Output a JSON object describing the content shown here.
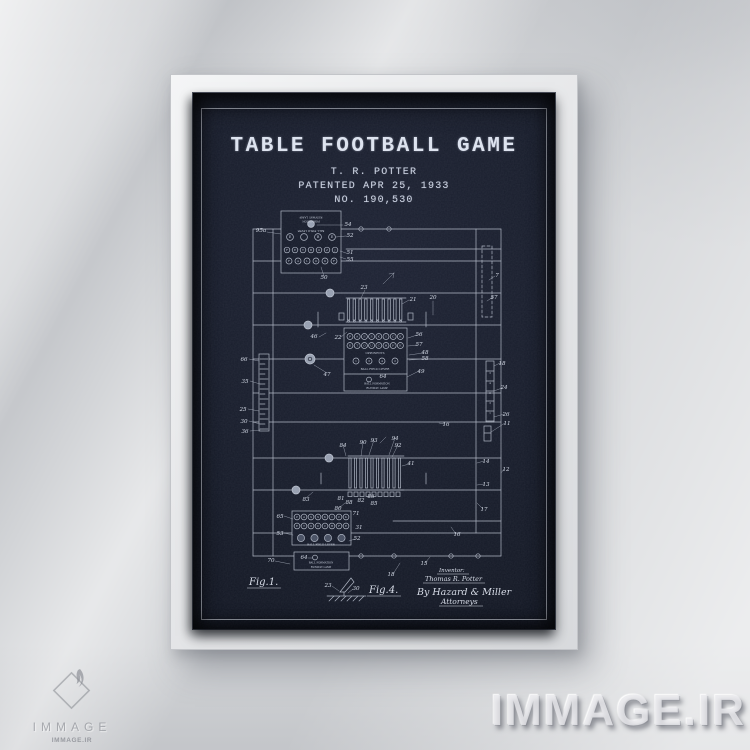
{
  "poster": {
    "title": "TABLE FOOTBALL GAME",
    "byline": "T. R. POTTER",
    "patent_date": "PATENTED APR 25, 1933",
    "patent_number": "NO. 190,530",
    "fig1": "Fig.1.",
    "fig4": "Fig.4.",
    "signature": {
      "role": "Inventor:",
      "name": "Thomas R. Potter",
      "firm": "By Hazard & Miller",
      "title": "Attorneys"
    },
    "colors": {
      "background": "#161b29",
      "line": "#c3cad8",
      "frame": "#eceded",
      "wall": "#d2d4d7"
    }
  },
  "figure": {
    "ref_labels": [
      [
        68,
        139,
        "95a"
      ],
      [
        155,
        133,
        "54"
      ],
      [
        157,
        144,
        "52"
      ],
      [
        157,
        161,
        "51"
      ],
      [
        157,
        168,
        "55"
      ],
      [
        131,
        186,
        "50"
      ],
      [
        171,
        196,
        "23"
      ],
      [
        220,
        208,
        "21"
      ],
      [
        240,
        206,
        "20"
      ],
      [
        121,
        245,
        "46"
      ],
      [
        145,
        246,
        "22"
      ],
      [
        226,
        243,
        "56"
      ],
      [
        226,
        253,
        "57"
      ],
      [
        232,
        261,
        "48"
      ],
      [
        232,
        267,
        "58"
      ],
      [
        228,
        280,
        "49"
      ],
      [
        134,
        283,
        "47"
      ],
      [
        51,
        268,
        "66"
      ],
      [
        52,
        290,
        "35"
      ],
      [
        50,
        318,
        "25"
      ],
      [
        51,
        330,
        "30"
      ],
      [
        52,
        340,
        "36"
      ],
      [
        304,
        184,
        "7"
      ],
      [
        301,
        206,
        "57"
      ],
      [
        253,
        333,
        "16"
      ],
      [
        150,
        354,
        "84"
      ],
      [
        170,
        351,
        "90"
      ],
      [
        181,
        349,
        "93"
      ],
      [
        202,
        347,
        "94"
      ],
      [
        205,
        354,
        "92"
      ],
      [
        218,
        372,
        "41"
      ],
      [
        293,
        370,
        "14"
      ],
      [
        313,
        378,
        "12"
      ],
      [
        293,
        393,
        "13"
      ],
      [
        309,
        272,
        "18"
      ],
      [
        311,
        296,
        "24"
      ],
      [
        313,
        323,
        "26"
      ],
      [
        314,
        332,
        "11"
      ],
      [
        113,
        408,
        "83"
      ],
      [
        148,
        407,
        "81"
      ],
      [
        156,
        411,
        "88"
      ],
      [
        168,
        409,
        "82"
      ],
      [
        178,
        405,
        "86"
      ],
      [
        181,
        412,
        "85"
      ],
      [
        145,
        417,
        "80"
      ],
      [
        163,
        422,
        "71"
      ],
      [
        166,
        436,
        "31"
      ],
      [
        87,
        425,
        "65"
      ],
      [
        87,
        442,
        "53"
      ],
      [
        164,
        447,
        "52"
      ],
      [
        111,
        466,
        "64"
      ],
      [
        78,
        469,
        "70"
      ],
      [
        291,
        418,
        "17"
      ],
      [
        264,
        443,
        "16"
      ],
      [
        231,
        472,
        "15"
      ],
      [
        198,
        483,
        "18"
      ],
      [
        135,
        494,
        "23"
      ],
      [
        163,
        497,
        "30"
      ],
      [
        190,
        285,
        "64"
      ]
    ],
    "texts": [
      [
        118,
        123.5,
        "RUNWAY LAMP",
        2.8,
        180
      ],
      [
        118,
        127.5,
        "FORMATION",
        2.6,
        180
      ],
      [
        118,
        137,
        "BALL FIELD LEVER",
        2.6,
        180
      ],
      [
        182,
        261,
        "OPPONENTS",
        2.8,
        0
      ],
      [
        182,
        277,
        "BALL FIELD LEVER",
        2.8,
        0
      ],
      [
        184,
        291.5,
        "BALL FORMATION",
        2.6,
        0
      ],
      [
        184,
        296,
        "RUNWAY LAMP",
        2.6,
        0
      ],
      [
        128,
        452.5,
        "BALL FIELD LEVER",
        2.7,
        0
      ],
      [
        128,
        470.5,
        "BALL FORMATION",
        2.5,
        0
      ],
      [
        128,
        475,
        "RUNWAY LAMP",
        2.5,
        0
      ],
      [
        297,
        281,
        "3",
        2.5,
        0
      ],
      [
        297,
        291,
        "4",
        2.5,
        0
      ],
      [
        297,
        301,
        "2",
        2.5,
        0
      ],
      [
        297,
        311,
        "3",
        2.5,
        0
      ],
      [
        297,
        321,
        "1",
        2.5,
        0
      ]
    ],
    "panels": {
      "top_row1": [
        "E",
        "",
        "B",
        "E"
      ],
      "top_row2": [
        "F",
        "E",
        "T",
        "B",
        "O",
        "Z",
        "J"
      ],
      "top_row3": [
        "F",
        "A",
        "L",
        "O",
        "D",
        "F"
      ],
      "mid_row1": [
        "P",
        "A",
        "S",
        "S",
        "K",
        "I",
        "C",
        "K"
      ],
      "mid_row2": [
        "E",
        "T",
        "O",
        "U",
        "C",
        "H",
        "F",
        "E"
      ],
      "mid_row3": [
        "1",
        "3",
        "4",
        "2"
      ],
      "bot_row1": [
        "P",
        "A",
        "S",
        "S",
        "K",
        "I",
        "C",
        "K"
      ],
      "bot_row2": [
        "E",
        "T",
        "O",
        "U",
        "C",
        "H",
        "F",
        "E"
      ],
      "bot_row3": [
        "",
        "",
        "",
        ""
      ]
    }
  },
  "watermark": {
    "text": "IMMAGE.IR"
  },
  "logo": {
    "name": "IMMAGE",
    "sub": "IMMAGE.IR"
  }
}
